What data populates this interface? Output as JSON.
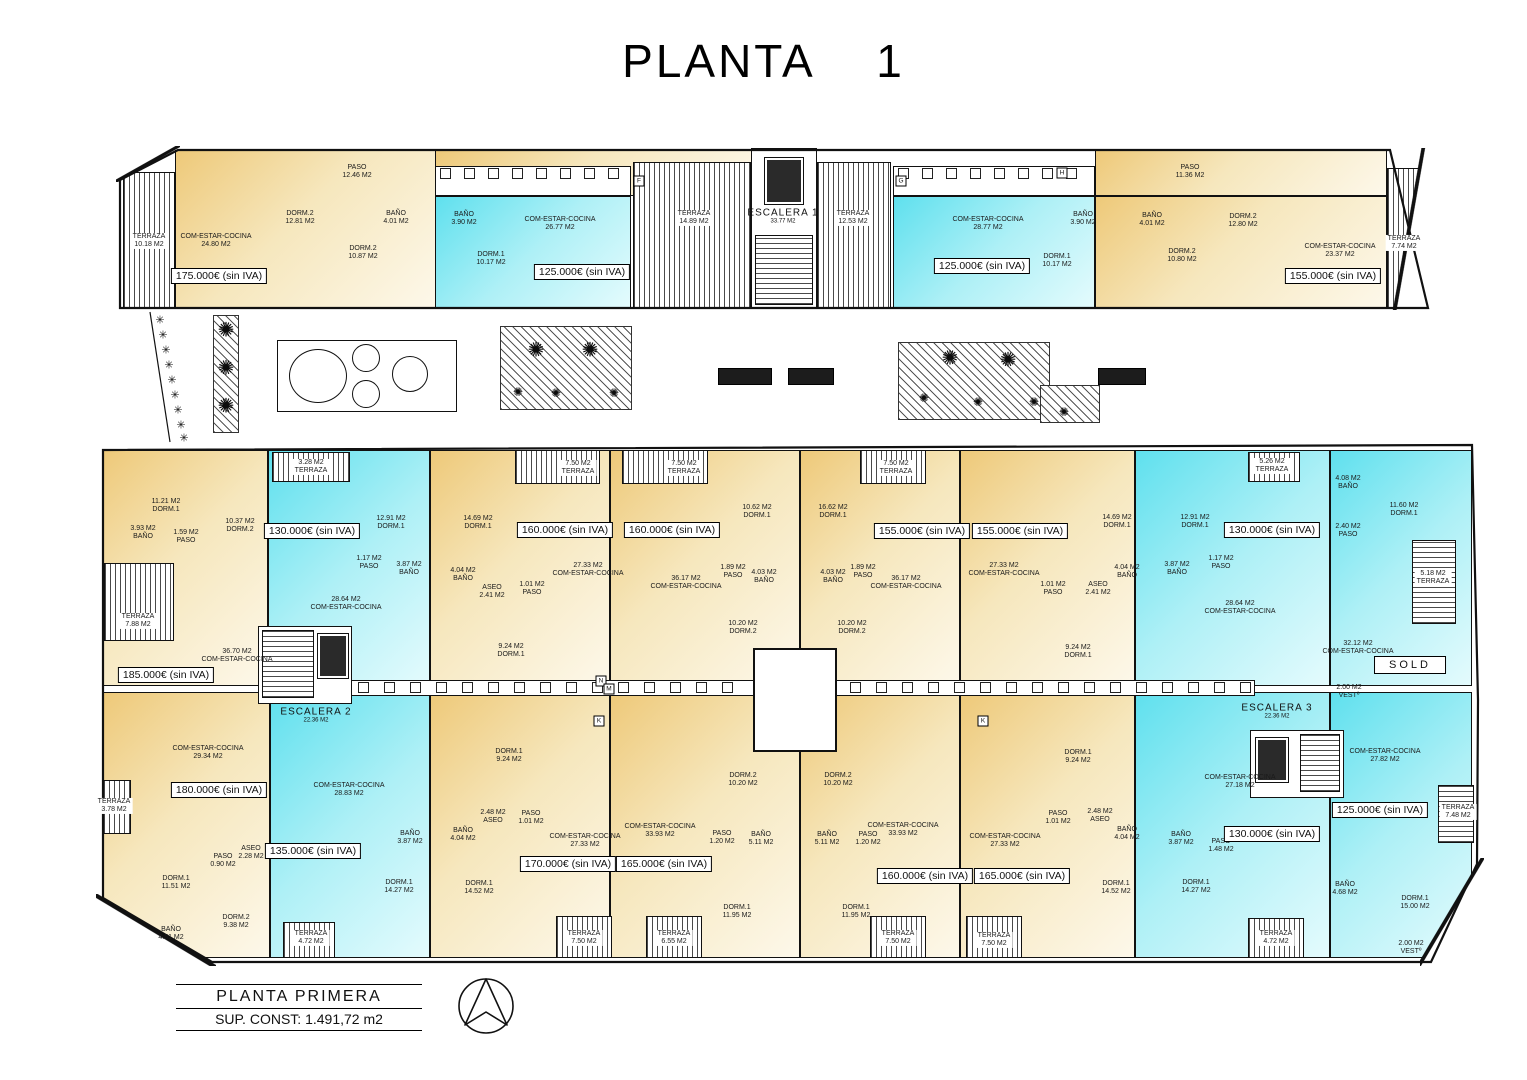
{
  "title": "PLANTA    1",
  "footer": {
    "name": "PLANTA PRIMERA",
    "area": "SUP. CONST: 1.491,72 m2"
  },
  "colors": {
    "cream": "#eec979",
    "cream_light": "#fdf8ea",
    "cyan": "#5fe0ee",
    "cyan_light": "#e4fbfd",
    "wall": "#111111"
  },
  "icons": {
    "plant": "✺",
    "tree": "✳",
    "compass": "north-arrow"
  },
  "sold": {
    "t": "SOLD",
    "x": 1410,
    "y": 665
  },
  "stairs": [
    {
      "a": "ESCALERA 1",
      "b": "33.77 M2",
      "x": 783,
      "y": 216
    },
    {
      "a": "ESCALERA 2",
      "b": "22.36 M2",
      "x": 316,
      "y": 715
    },
    {
      "a": "ESCALERA 3",
      "b": "22.36 M2",
      "x": 1277,
      "y": 711
    }
  ],
  "prices": [
    {
      "t": "175.000€ (sin IVA)",
      "x": 219,
      "y": 276
    },
    {
      "t": "125.000€ (sin IVA)",
      "x": 582,
      "y": 272
    },
    {
      "t": "125.000€ (sin IVA)",
      "x": 982,
      "y": 266
    },
    {
      "t": "155.000€ (sin IVA)",
      "x": 1333,
      "y": 276
    },
    {
      "t": "185.000€ (sin IVA)",
      "x": 166,
      "y": 675
    },
    {
      "t": "130.000€ (sin IVA)",
      "x": 312,
      "y": 531
    },
    {
      "t": "160.000€ (sin IVA)",
      "x": 565,
      "y": 530
    },
    {
      "t": "160.000€ (sin IVA)",
      "x": 672,
      "y": 530
    },
    {
      "t": "155.000€ (sin IVA)",
      "x": 922,
      "y": 531
    },
    {
      "t": "155.000€ (sin IVA)",
      "x": 1020,
      "y": 531
    },
    {
      "t": "130.000€ (sin IVA)",
      "x": 1272,
      "y": 530
    },
    {
      "t": "180.000€ (sin IVA)",
      "x": 219,
      "y": 790
    },
    {
      "t": "135.000€ (sin IVA)",
      "x": 313,
      "y": 851
    },
    {
      "t": "170.000€ (sin IVA)",
      "x": 568,
      "y": 864
    },
    {
      "t": "165.000€ (sin IVA)",
      "x": 664,
      "y": 864
    },
    {
      "t": "160.000€ (sin IVA)",
      "x": 925,
      "y": 876
    },
    {
      "t": "165.000€ (sin IVA)",
      "x": 1022,
      "y": 876
    },
    {
      "t": "130.000€ (sin IVA)",
      "x": 1272,
      "y": 834
    },
    {
      "t": "125.000€ (sin IVA)",
      "x": 1380,
      "y": 810
    }
  ],
  "letters": [
    {
      "t": "F",
      "x": 639,
      "y": 181
    },
    {
      "t": "G",
      "x": 901,
      "y": 181
    },
    {
      "t": "H",
      "x": 1062,
      "y": 173
    },
    {
      "t": "N",
      "x": 601,
      "y": 681
    },
    {
      "t": "M",
      "x": 609,
      "y": 689
    },
    {
      "t": "K",
      "x": 599,
      "y": 721
    },
    {
      "t": "K",
      "x": 983,
      "y": 721
    }
  ],
  "rooms": [
    {
      "l1": "TERRAZA",
      "l2": "10.18 M2",
      "x": 149,
      "y": 241,
      "bg": 1
    },
    {
      "l1": "COM-ESTAR-COCINA",
      "l2": "24.80 M2",
      "x": 216,
      "y": 241
    },
    {
      "l1": "PASO",
      "l2": "12.46 M2",
      "x": 357,
      "y": 172
    },
    {
      "l1": "DORM.2",
      "l2": "12.81 M2",
      "x": 300,
      "y": 218
    },
    {
      "l1": "BAÑO",
      "l2": "4.01 M2",
      "x": 396,
      "y": 218
    },
    {
      "l1": "DORM.2",
      "l2": "10.87 M2",
      "x": 363,
      "y": 253
    },
    {
      "l1": "BAÑO",
      "l2": "3.90 M2",
      "x": 464,
      "y": 219
    },
    {
      "l1": "COM-ESTAR-COCINA",
      "l2": "26.77 M2",
      "x": 560,
      "y": 224
    },
    {
      "l1": "DORM.1",
      "l2": "10.17 M2",
      "x": 491,
      "y": 259
    },
    {
      "l1": "TERRAZA",
      "l2": "14.89 M2",
      "x": 694,
      "y": 218,
      "bg": 1
    },
    {
      "l1": "TERRAZA",
      "l2": "12.53 M2",
      "x": 853,
      "y": 218,
      "bg": 1
    },
    {
      "l1": "COM-ESTAR-COCINA",
      "l2": "28.77 M2",
      "x": 988,
      "y": 224
    },
    {
      "l1": "DORM.1",
      "l2": "10.17 M2",
      "x": 1057,
      "y": 261
    },
    {
      "l1": "BAÑO",
      "l2": "3.90 M2",
      "x": 1083,
      "y": 219
    },
    {
      "l1": "PASO",
      "l2": "11.36 M2",
      "x": 1190,
      "y": 172
    },
    {
      "l1": "BAÑO",
      "l2": "4.01 M2",
      "x": 1152,
      "y": 220
    },
    {
      "l1": "DORM.2",
      "l2": "10.80 M2",
      "x": 1182,
      "y": 256
    },
    {
      "l1": "DORM.2",
      "l2": "12.80 M2",
      "x": 1243,
      "y": 221
    },
    {
      "l1": "COM-ESTAR-COCINA",
      "l2": "23.37 M2",
      "x": 1340,
      "y": 251
    },
    {
      "l1": "TERRAZA",
      "l2": "7.74 M2",
      "x": 1404,
      "y": 243,
      "bg": 1
    },
    {
      "l1": "11.21 M2",
      "l2": "DORM.1",
      "x": 166,
      "y": 506
    },
    {
      "l1": "3.93 M2",
      "l2": "BAÑO",
      "x": 143,
      "y": 533
    },
    {
      "l1": "1.59 M2",
      "l2": "PASO",
      "x": 186,
      "y": 537
    },
    {
      "l1": "10.37 M2",
      "l2": "DORM.2",
      "x": 240,
      "y": 526
    },
    {
      "l1": "TERRAZA",
      "l2": "7.88 M2",
      "x": 138,
      "y": 621,
      "bg": 1
    },
    {
      "l1": "36.70 M2",
      "l2": "COM-ESTAR-COCINA",
      "x": 237,
      "y": 656
    },
    {
      "l1": "3.28 M2",
      "l2": "TERRAZA",
      "x": 311,
      "y": 467,
      "bg": 1
    },
    {
      "l1": "12.91 M2",
      "l2": "DORM.1",
      "x": 391,
      "y": 523
    },
    {
      "l1": "1.17 M2",
      "l2": "PASO",
      "x": 369,
      "y": 563
    },
    {
      "l1": "3.87 M2",
      "l2": "BAÑO",
      "x": 409,
      "y": 569
    },
    {
      "l1": "28.64 M2",
      "l2": "COM-ESTAR-COCINA",
      "x": 346,
      "y": 604
    },
    {
      "l1": "14.69 M2",
      "l2": "DORM.1",
      "x": 478,
      "y": 523
    },
    {
      "l1": "7.50 M2",
      "l2": "TERRAZA",
      "x": 578,
      "y": 468,
      "bg": 1
    },
    {
      "l1": "4.04 M2",
      "l2": "BAÑO",
      "x": 463,
      "y": 575
    },
    {
      "l1": "ASEO",
      "l2": "2.41 M2",
      "x": 492,
      "y": 592
    },
    {
      "l1": "1.01 M2",
      "l2": "PASO",
      "x": 532,
      "y": 589
    },
    {
      "l1": "27.33 M2",
      "l2": "COM-ESTAR-COCINA",
      "x": 588,
      "y": 570
    },
    {
      "l1": "9.24 M2",
      "l2": "DORM.1",
      "x": 511,
      "y": 651
    },
    {
      "l1": "7.50 M2",
      "l2": "TERRAZA",
      "x": 684,
      "y": 468,
      "bg": 1
    },
    {
      "l1": "36.17 M2",
      "l2": "COM-ESTAR-COCINA",
      "x": 686,
      "y": 583
    },
    {
      "l1": "1.89 M2",
      "l2": "PASO",
      "x": 733,
      "y": 572
    },
    {
      "l1": "10.62 M2",
      "l2": "DORM.1",
      "x": 757,
      "y": 512
    },
    {
      "l1": "4.03 M2",
      "l2": "BAÑO",
      "x": 764,
      "y": 577
    },
    {
      "l1": "10.20 M2",
      "l2": "DORM.2",
      "x": 743,
      "y": 628
    },
    {
      "l1": "16.62 M2",
      "l2": "DORM.1",
      "x": 833,
      "y": 512
    },
    {
      "l1": "4.03 M2",
      "l2": "BAÑO",
      "x": 833,
      "y": 577
    },
    {
      "l1": "1.89 M2",
      "l2": "PASO",
      "x": 863,
      "y": 572
    },
    {
      "l1": "10.20 M2",
      "l2": "DORM.2",
      "x": 852,
      "y": 628
    },
    {
      "l1": "36.17 M2",
      "l2": "COM-ESTAR-COCINA",
      "x": 906,
      "y": 583
    },
    {
      "l1": "7.50 M2",
      "l2": "TERRAZA",
      "x": 896,
      "y": 468,
      "bg": 1
    },
    {
      "l1": "27.33 M2",
      "l2": "COM-ESTAR-COCINA",
      "x": 1004,
      "y": 570
    },
    {
      "l1": "14.69 M2",
      "l2": "DORM.1",
      "x": 1117,
      "y": 522
    },
    {
      "l1": "1.01 M2",
      "l2": "PASO",
      "x": 1053,
      "y": 589
    },
    {
      "l1": "ASEO",
      "l2": "2.41 M2",
      "x": 1098,
      "y": 589
    },
    {
      "l1": "4.04 M2",
      "l2": "BAÑO",
      "x": 1127,
      "y": 572
    },
    {
      "l1": "9.24 M2",
      "l2": "DORM.1",
      "x": 1078,
      "y": 652
    },
    {
      "l1": "12.91 M2",
      "l2": "DORM.1",
      "x": 1195,
      "y": 522
    },
    {
      "l1": "5.26 M2",
      "l2": "TERRAZA",
      "x": 1272,
      "y": 466,
      "bg": 1
    },
    {
      "l1": "1.17 M2",
      "l2": "PASO",
      "x": 1221,
      "y": 563
    },
    {
      "l1": "3.87 M2",
      "l2": "BAÑO",
      "x": 1177,
      "y": 569
    },
    {
      "l1": "28.64 M2",
      "l2": "COM-ESTAR-COCINA",
      "x": 1240,
      "y": 608
    },
    {
      "l1": "4.08 M2",
      "l2": "BAÑO",
      "x": 1348,
      "y": 483
    },
    {
      "l1": "2.40 M2",
      "l2": "PASO",
      "x": 1348,
      "y": 531
    },
    {
      "l1": "11.60 M2",
      "l2": "DORM.1",
      "x": 1404,
      "y": 510
    },
    {
      "l1": "5.18 M2",
      "l2": "TERRAZA",
      "x": 1433,
      "y": 578,
      "bg": 1
    },
    {
      "l1": "32.12 M2",
      "l2": "COM-ESTAR-COCINA",
      "x": 1358,
      "y": 648
    },
    {
      "l1": "2.00 M2",
      "l2": "VESTº",
      "x": 1349,
      "y": 692
    },
    {
      "l1": "COM-ESTAR-COCINA",
      "l2": "29.34 M2",
      "x": 208,
      "y": 753
    },
    {
      "l1": "TERRAZA",
      "l2": "3.78 M2",
      "x": 114,
      "y": 806,
      "bg": 1
    },
    {
      "l1": "DORM.1",
      "l2": "11.51 M2",
      "x": 176,
      "y": 883
    },
    {
      "l1": "PASO",
      "l2": "0.90 M2",
      "x": 223,
      "y": 861
    },
    {
      "l1": "ASEO",
      "l2": "2.28 M2",
      "x": 251,
      "y": 853
    },
    {
      "l1": "BAÑO",
      "l2": "4.51 M2",
      "x": 171,
      "y": 934
    },
    {
      "l1": "DORM.2",
      "l2": "9.38 M2",
      "x": 236,
      "y": 922
    },
    {
      "l1": "COM-ESTAR-COCINA",
      "l2": "28.83 M2",
      "x": 349,
      "y": 790
    },
    {
      "l1": "BAÑO",
      "l2": "3.87 M2",
      "x": 410,
      "y": 838
    },
    {
      "l1": "DORM.1",
      "l2": "14.27 M2",
      "x": 399,
      "y": 887
    },
    {
      "l1": "TERRAZA",
      "l2": "4.72 M2",
      "x": 311,
      "y": 938,
      "bg": 1
    },
    {
      "l1": "DORM.1",
      "l2": "9.24 M2",
      "x": 509,
      "y": 756
    },
    {
      "l1": "2.48 M2",
      "l2": "ASEO",
      "x": 493,
      "y": 817
    },
    {
      "l1": "PASO",
      "l2": "1.01 M2",
      "x": 531,
      "y": 818
    },
    {
      "l1": "BAÑO",
      "l2": "4.04 M2",
      "x": 463,
      "y": 835
    },
    {
      "l1": "DORM.1",
      "l2": "14.52 M2",
      "x": 479,
      "y": 888
    },
    {
      "l1": "COM-ESTAR-COCINA",
      "l2": "27.33 M2",
      "x": 585,
      "y": 841
    },
    {
      "l1": "TERRAZA",
      "l2": "7.50 M2",
      "x": 584,
      "y": 938,
      "bg": 1
    },
    {
      "l1": "COM-ESTAR-COCINA",
      "l2": "33.93 M2",
      "x": 660,
      "y": 831
    },
    {
      "l1": "PASO",
      "l2": "1.20 M2",
      "x": 722,
      "y": 838
    },
    {
      "l1": "DORM.2",
      "l2": "10.20 M2",
      "x": 743,
      "y": 780
    },
    {
      "l1": "BAÑO",
      "l2": "5.11 M2",
      "x": 761,
      "y": 839
    },
    {
      "l1": "DORM.1",
      "l2": "11.95 M2",
      "x": 737,
      "y": 912
    },
    {
      "l1": "TERRAZA",
      "l2": "6.55 M2",
      "x": 674,
      "y": 938,
      "bg": 1
    },
    {
      "l1": "DORM.2",
      "l2": "10.20 M2",
      "x": 838,
      "y": 780
    },
    {
      "l1": "BAÑO",
      "l2": "5.11 M2",
      "x": 827,
      "y": 839
    },
    {
      "l1": "PASO",
      "l2": "1.20 M2",
      "x": 868,
      "y": 839
    },
    {
      "l1": "DORM.1",
      "l2": "11.95 M2",
      "x": 856,
      "y": 912
    },
    {
      "l1": "COM-ESTAR-COCINA",
      "l2": "33.93 M2",
      "x": 903,
      "y": 830
    },
    {
      "l1": "TERRAZA",
      "l2": "7.50 M2",
      "x": 898,
      "y": 938,
      "bg": 1
    },
    {
      "l1": "COM-ESTAR-COCINA",
      "l2": "27.33 M2",
      "x": 1005,
      "y": 841
    },
    {
      "l1": "DORM.1",
      "l2": "9.24 M2",
      "x": 1078,
      "y": 757
    },
    {
      "l1": "PASO",
      "l2": "1.01 M2",
      "x": 1058,
      "y": 818
    },
    {
      "l1": "2.48 M2",
      "l2": "ASEO",
      "x": 1100,
      "y": 816
    },
    {
      "l1": "BAÑO",
      "l2": "4.04 M2",
      "x": 1127,
      "y": 834
    },
    {
      "l1": "DORM.1",
      "l2": "14.52 M2",
      "x": 1116,
      "y": 888
    },
    {
      "l1": "TERRAZA",
      "l2": "7.50 M2",
      "x": 994,
      "y": 940,
      "bg": 1
    },
    {
      "l1": "COM-ESTAR-COCINA",
      "l2": "27.18 M2",
      "x": 1240,
      "y": 782
    },
    {
      "l1": "BAÑO",
      "l2": "3.87 M2",
      "x": 1181,
      "y": 839
    },
    {
      "l1": "PASO",
      "l2": "1.48 M2",
      "x": 1221,
      "y": 846
    },
    {
      "l1": "DORM.1",
      "l2": "14.27 M2",
      "x": 1196,
      "y": 887
    },
    {
      "l1": "TERRAZA",
      "l2": "4.72 M2",
      "x": 1276,
      "y": 938,
      "bg": 1
    },
    {
      "l1": "COM-ESTAR-COCINA",
      "l2": "27.82 M2",
      "x": 1385,
      "y": 756
    },
    {
      "l1": "TERRAZA",
      "l2": "7.48 M2",
      "x": 1458,
      "y": 812,
      "bg": 1
    },
    {
      "l1": "BAÑO",
      "l2": "4.68 M2",
      "x": 1345,
      "y": 889
    },
    {
      "l1": "DORM.1",
      "l2": "15.00 M2",
      "x": 1415,
      "y": 903
    },
    {
      "l1": "2.00 M2",
      "l2": "VESTº",
      "x": 1411,
      "y": 948
    }
  ]
}
